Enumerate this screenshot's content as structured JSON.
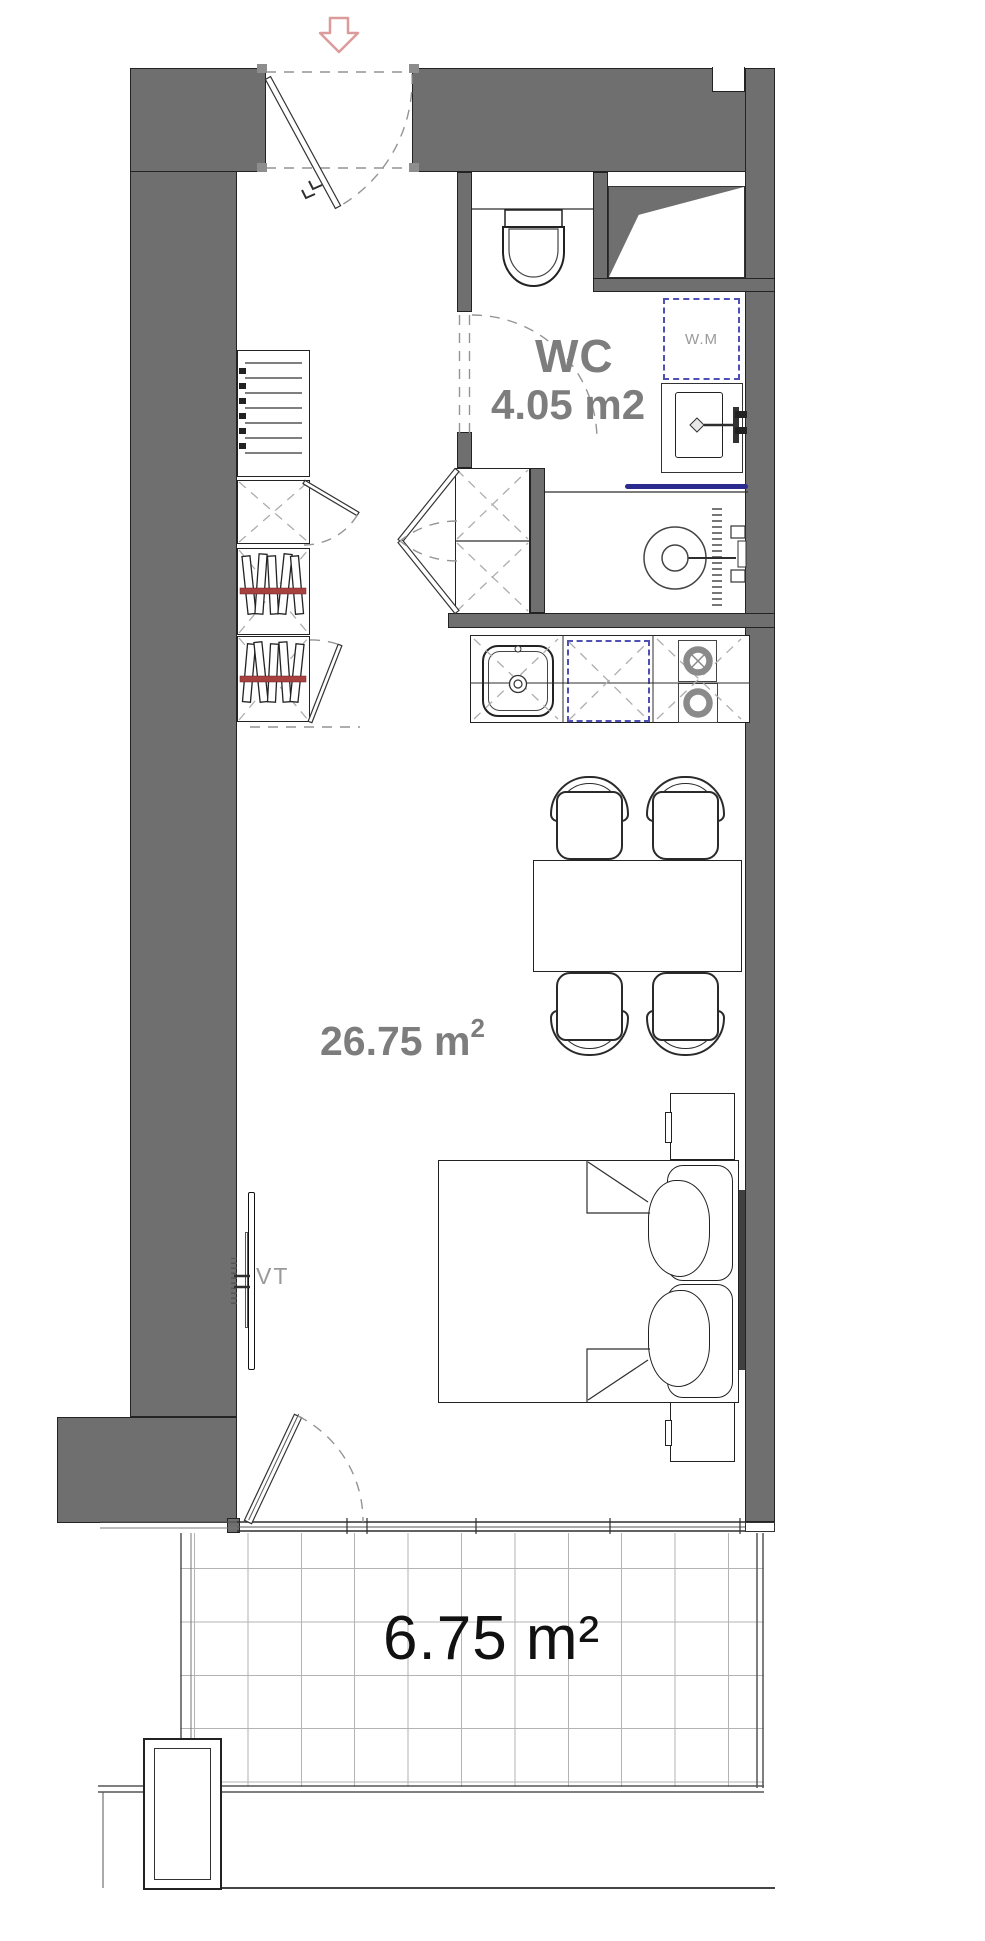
{
  "plan": {
    "rooms": {
      "wc": {
        "name": "WC",
        "area": "4.05 m2"
      },
      "living": {
        "area_value": "26.75",
        "area_unit": "m",
        "area_exponent": "2"
      },
      "balcony": {
        "area": "6.75 m²"
      }
    },
    "appliances": {
      "washing_machine": "W.M"
    },
    "fixtures": {
      "tv": "VT"
    },
    "colors": {
      "wall_fill": "#6f6f6f",
      "wall_outline": "#232323",
      "room_label_gray": "#7d7d7d",
      "balcony_label": "#111111",
      "appliance_dashed_blue": "#4e50b4",
      "wardrobe_rail_red": "#a84040",
      "shower_glass_blue": "#2a2a8f",
      "entrance_arrow_pink": "#dc9b9b",
      "tile_grid": "#b3b3b3"
    }
  }
}
